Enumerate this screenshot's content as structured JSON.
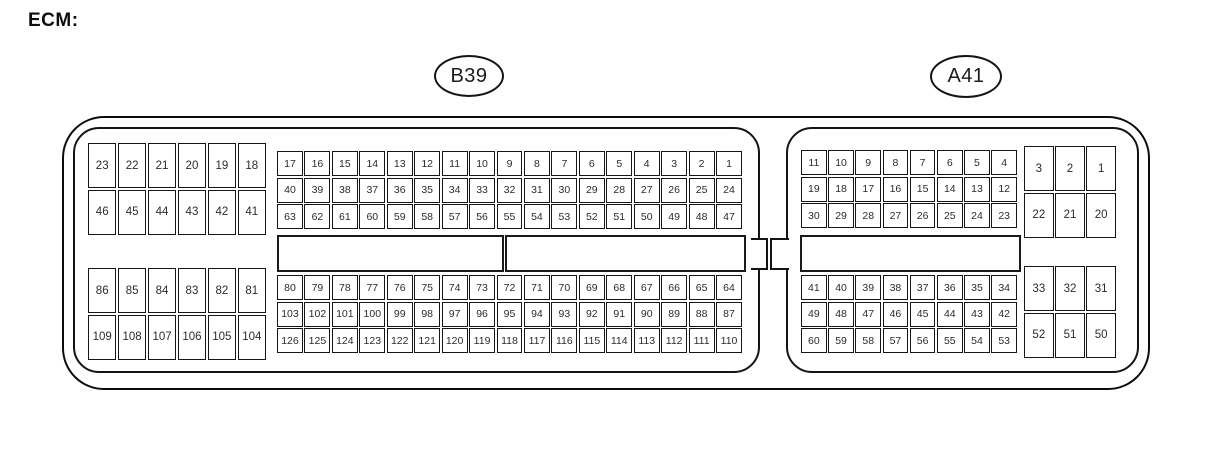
{
  "title": "ECM:",
  "colors": {
    "line": "#141414",
    "background": "#ffffff",
    "text": "#2b2b2b"
  },
  "connectors": {
    "b39": {
      "label": "B39",
      "left_top": [
        [
          23,
          22,
          21,
          20,
          19,
          18
        ],
        [
          46,
          45,
          44,
          43,
          42,
          41
        ]
      ],
      "left_bottom": [
        [
          86,
          85,
          84,
          83,
          82,
          81
        ],
        [
          109,
          108,
          107,
          106,
          105,
          104
        ]
      ],
      "top": [
        [
          17,
          16,
          15,
          14,
          13,
          12,
          11,
          10,
          9,
          8,
          7,
          6,
          5,
          4,
          3,
          2,
          1
        ],
        [
          40,
          39,
          38,
          37,
          36,
          35,
          34,
          33,
          32,
          31,
          30,
          29,
          28,
          27,
          26,
          25,
          24
        ],
        [
          63,
          62,
          61,
          60,
          59,
          58,
          57,
          56,
          55,
          54,
          53,
          52,
          51,
          50,
          49,
          48,
          47
        ]
      ],
      "bottom": [
        [
          80,
          79,
          78,
          77,
          76,
          75,
          74,
          73,
          72,
          71,
          70,
          69,
          68,
          67,
          66,
          65,
          64
        ],
        [
          103,
          102,
          101,
          100,
          99,
          98,
          97,
          96,
          95,
          94,
          93,
          92,
          91,
          90,
          89,
          88,
          87
        ],
        [
          126,
          125,
          124,
          123,
          122,
          121,
          120,
          119,
          118,
          117,
          116,
          115,
          114,
          113,
          112,
          111,
          110
        ]
      ]
    },
    "a41": {
      "label": "A41",
      "top": [
        [
          11,
          10,
          9,
          8,
          7,
          6,
          5,
          4
        ],
        [
          19,
          18,
          17,
          16,
          15,
          14,
          13,
          12
        ],
        [
          30,
          29,
          28,
          27,
          26,
          25,
          24,
          23
        ]
      ],
      "right_top": [
        [
          3,
          2,
          1
        ],
        [
          22,
          21,
          20
        ]
      ],
      "bottom": [
        [
          41,
          40,
          39,
          38,
          37,
          36,
          35,
          34
        ],
        [
          49,
          48,
          47,
          46,
          45,
          44,
          43,
          42
        ],
        [
          60,
          59,
          58,
          57,
          56,
          55,
          54,
          53
        ]
      ],
      "right_bottom": [
        [
          33,
          32,
          31
        ],
        [
          52,
          51,
          50
        ]
      ]
    }
  }
}
